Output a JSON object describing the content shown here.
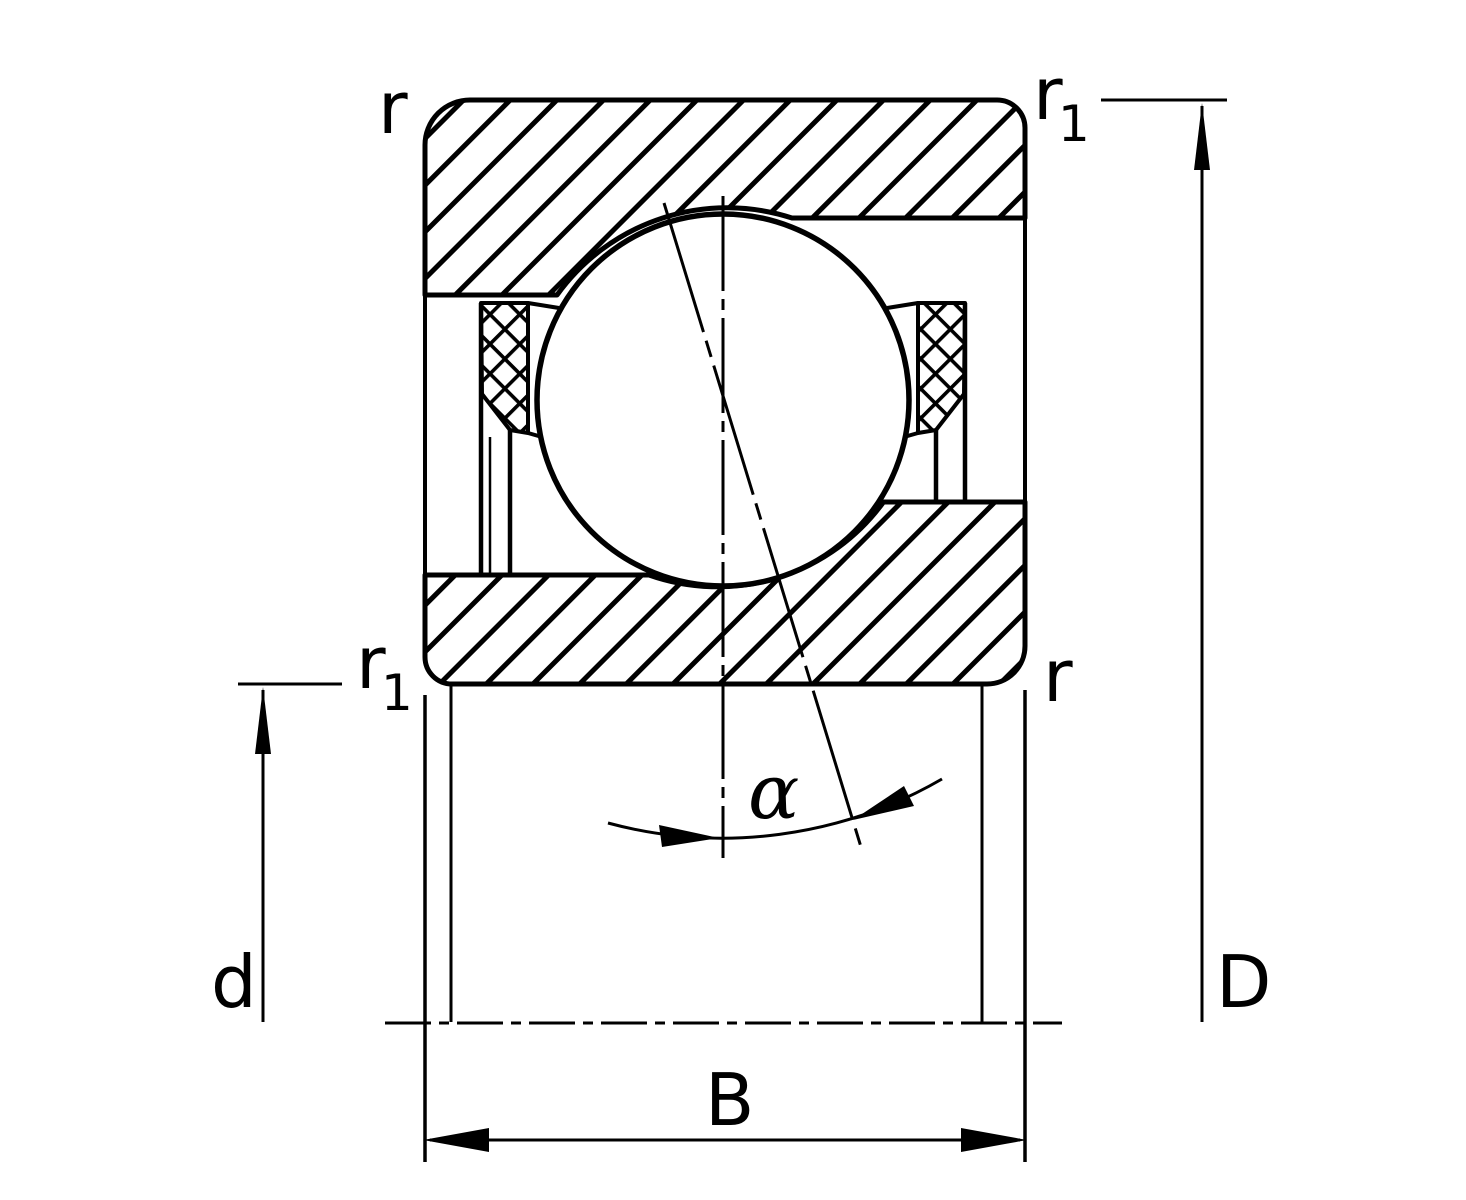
{
  "diagram": {
    "labels": {
      "corner_top_left": "r",
      "corner_top_right_base": "r",
      "corner_top_right_sub": "1",
      "corner_mid_left_base": "r",
      "corner_mid_left_sub": "1",
      "corner_mid_right": "r",
      "bore_diameter": "d",
      "outer_diameter": "D",
      "width": "B",
      "contact_angle": "α"
    },
    "colors": {
      "line": "#000000",
      "background": "#ffffff"
    }
  }
}
